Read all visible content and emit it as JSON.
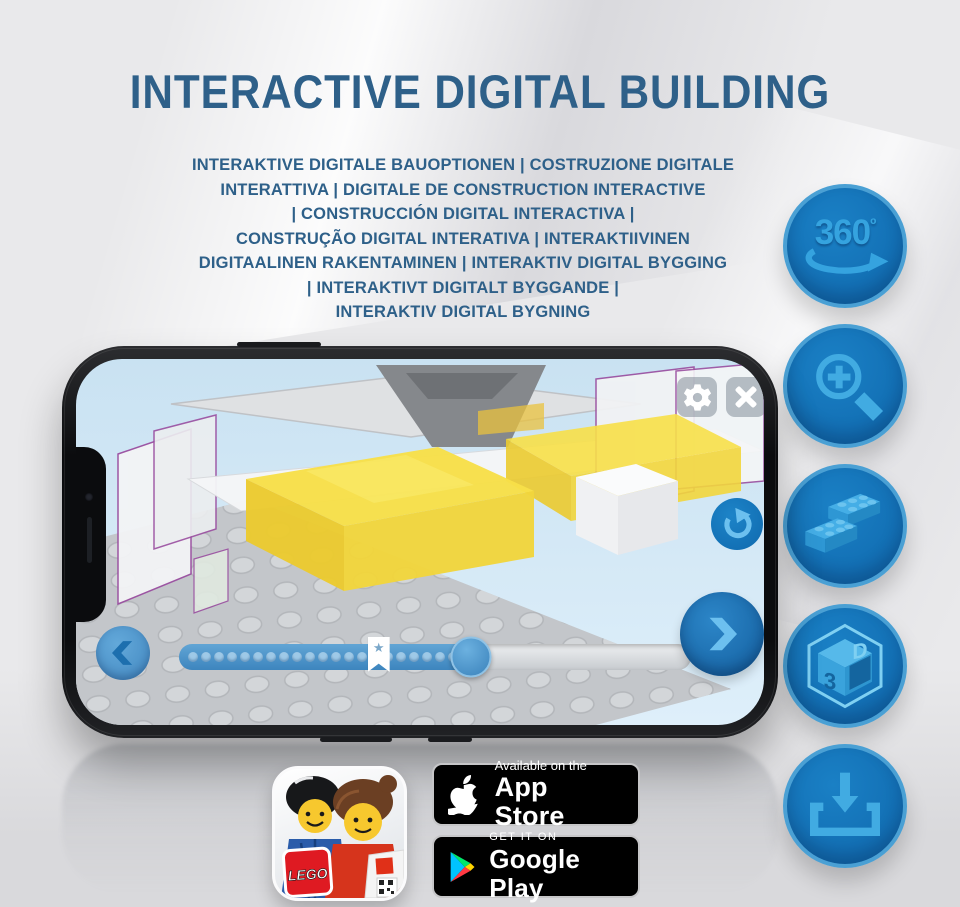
{
  "title": "INTERACTIVE DIGITAL BUILDING",
  "subtitle_lines": [
    "INTERAKTIVE DIGITALE BAUOPTIONEN | COSTRUZIONE DIGITALE",
    "INTERATTIVA | DIGITALE DE CONSTRUCTION INTERACTIVE",
    "| CONSTRUCCIÓN DIGITAL INTERACTIVA |",
    "CONSTRUÇÃO DIGITAL INTERATIVA | INTERAKTIIVINEN",
    "DIGITAALINEN RAKENTAMINEN | INTERAKTIV DIGITAL BYGGING",
    "| INTERAKTIVT DIGITALT BYGGANDE |",
    "INTERAKTIV DIGITAL BYGNING"
  ],
  "features": [
    {
      "name": "360-degree-view",
      "icon": "rotate-360-icon",
      "label": "360",
      "degree": "º"
    },
    {
      "name": "zoom",
      "icon": "zoom-in-icon"
    },
    {
      "name": "brick-building",
      "icon": "lego-brick-icon"
    },
    {
      "name": "3d-view",
      "icon": "cube-3d-icon",
      "face_left": "3",
      "face_right": "D"
    },
    {
      "name": "download",
      "icon": "download-icon"
    }
  ],
  "phone": {
    "screen": {
      "toolbar": {
        "settings_icon": "gear-icon",
        "close_icon": "close-icon"
      },
      "reset_icon": "reset-rotation-icon",
      "nav": {
        "prev_icon": "chevron-left-icon",
        "next_icon": "chevron-right-icon"
      },
      "progress": {
        "dot_count": 21,
        "filled_percent": 57,
        "star_percent": 39,
        "star_icon": "star-bookmark-icon",
        "star_glyph": "★"
      }
    }
  },
  "badges": {
    "lego_app": {
      "icon": "lego-app-icon",
      "logo_text": "LEGO"
    },
    "app_store": {
      "icon": "apple-icon",
      "line1": "Available on the",
      "line2": "App Store"
    },
    "google_play": {
      "icon": "google-play-icon",
      "line1": "GET IT ON",
      "line2": "Google Play"
    }
  },
  "colors": {
    "title_blue": "#2e6089",
    "circle_blue": "#1173ba",
    "circle_rim": "#4aa0d4",
    "icon_blue": "#41abe2",
    "screen_blue": "#cfe6f4",
    "progress_blue": "#4a93ca",
    "lego_yellow": "#f5dd42"
  }
}
